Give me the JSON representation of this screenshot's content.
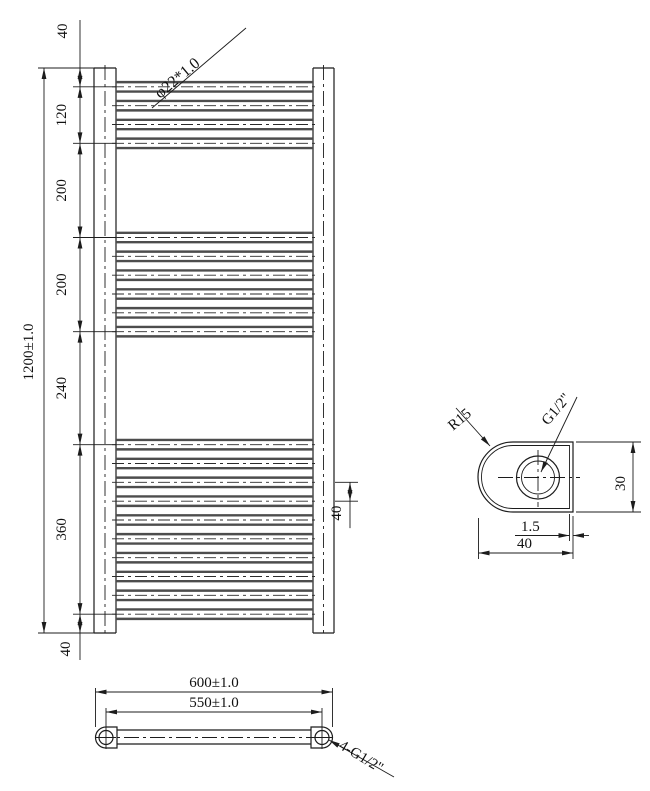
{
  "drawing_title": "towel-radiator-technical-drawing",
  "colors": {
    "background": "#ffffff",
    "line": "#1c1c1c",
    "tube_edge": "#4d4d4d"
  },
  "front_view": {
    "overall_label": "1200±1.0",
    "tube_spec_label": "φ22*1.0",
    "pitch_label": "40",
    "segments": [
      {
        "mm": 40,
        "label": "40"
      },
      {
        "mm": 120,
        "label": "120"
      },
      {
        "mm": 200,
        "label": "200"
      },
      {
        "mm": 200,
        "label": "200"
      },
      {
        "mm": 240,
        "label": "240"
      },
      {
        "mm": 360,
        "label": "360"
      },
      {
        "mm": 40,
        "label": "40"
      }
    ],
    "tube_groups": [
      {
        "start_mm": 40,
        "end_mm": 160,
        "count": 4
      },
      {
        "start_mm": 360,
        "end_mm": 560,
        "count": 6
      },
      {
        "start_mm": 800,
        "end_mm": 1160,
        "count": 10
      }
    ]
  },
  "bottom_view": {
    "overall_width_label": "600±1.0",
    "center_distance_label": "550±1.0",
    "connections_label": "4-G1/2\""
  },
  "detail_view": {
    "radius_label": "R15",
    "thread_label": "G1/2\"",
    "height_label": "30",
    "wall_thickness_label": "1.5",
    "width_label": "40"
  }
}
